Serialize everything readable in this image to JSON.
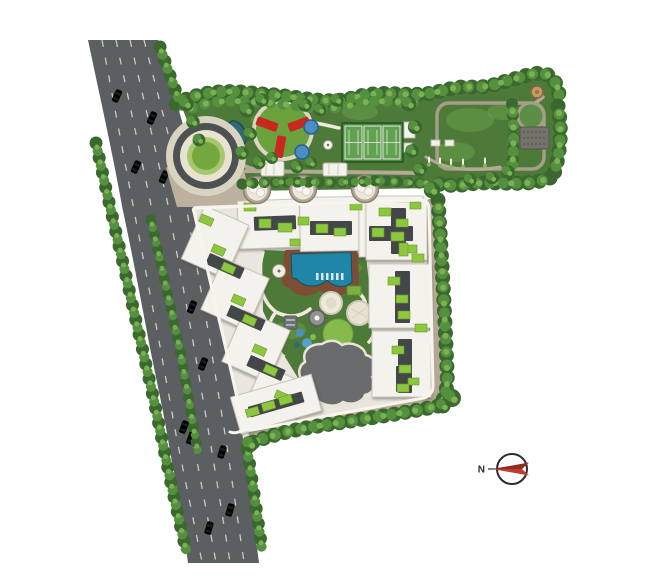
{
  "compass": {
    "label": "N"
  },
  "features": [
    "main-road",
    "street-trees",
    "median-trees",
    "entrance-roundabout",
    "red-pinwheel-plaza",
    "splash-pads",
    "tennis-courts",
    "pergolas",
    "great-lawn",
    "seating-deck",
    "fitness-trail",
    "tree-planters",
    "residential-blocks",
    "roof-gardens",
    "swimming-pool",
    "pool-deck",
    "reflecting-pond",
    "kids-play-area",
    "walking-paths",
    "boundary-hedge",
    "compass-north"
  ],
  "colors": {
    "road": "#5c5f61",
    "lane": "#e3e4e4",
    "plaza": "#bcb19f",
    "apron": "#d9d3c1",
    "ring_dark": "#4e5154",
    "ring_cream": "#e8e2d0",
    "lawn": "#4d7a39",
    "lawn_light": "#6ba24b",
    "court_border": "#2e5c2b",
    "court_bg": "#4e8a3f",
    "court": "#63a152",
    "tree_dark": "#3b682e",
    "tree_mid": "#55903f",
    "tree_light": "#7cb454",
    "building": "#f4f2ec",
    "building_shadow": "#c6c2b8",
    "strip": "#44474a",
    "roof": "#8dc63f",
    "pool_deck": "#7d4e33",
    "pool_water": "#1f86a8",
    "pond": "#696b6d",
    "path": "#efeadc",
    "sidewalk": "#b5a895",
    "walk": "#b3a997",
    "pinwheel_red": "#c9281e",
    "teal_pond": "#2e6b74",
    "play_blue": "#4a8fc0",
    "glade": "#85bb4a",
    "tan": "#c59a63",
    "compass_red_dark": "#8e2b22",
    "compass_red": "#c23b2e",
    "ink": "#2b2b2b",
    "platform": "#e9e6df"
  }
}
